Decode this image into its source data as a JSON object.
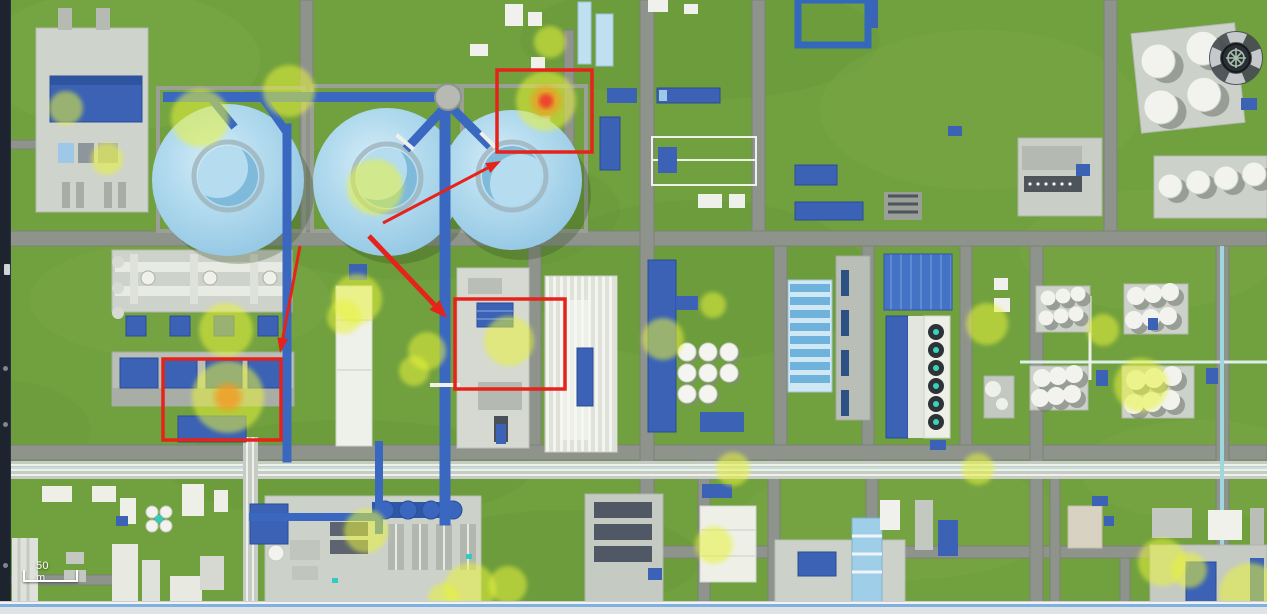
{
  "view": {
    "type": "3d-industrial-site-map"
  },
  "map": {
    "scale_bar": {
      "label": "50 m"
    },
    "compass": {
      "icon": "compass-navigation-icon"
    }
  },
  "colors": {
    "grass": "#71a03e",
    "road": "#8e948c",
    "pad": "#ccd1ca",
    "building_blue": "#3b62b4",
    "sphere_blue": "#a9d7ec",
    "pipe_blue": "#3a68c0",
    "heat_yellow": "#e8f238",
    "heat_core_orange": "#f29a1f",
    "heat_core_red": "#ee3a2e",
    "annotation_red": "#e6231b",
    "sidebar_dark": "#1d2430",
    "bottombar_blue": "#7fb0de"
  },
  "annotations": {
    "boxes": [
      {
        "x": 497,
        "y": 70,
        "w": 95,
        "h": 82
      },
      {
        "x": 163,
        "y": 359,
        "w": 118,
        "h": 81
      },
      {
        "x": 455,
        "y": 299,
        "w": 110,
        "h": 90
      }
    ],
    "arrows": [
      {
        "x1": 383,
        "y1": 223,
        "x2": 501,
        "y2": 161,
        "width": 3
      },
      {
        "x1": 369,
        "y1": 236,
        "x2": 447,
        "y2": 318,
        "width": 5
      },
      {
        "x1": 300,
        "y1": 246,
        "x2": 280,
        "y2": 353,
        "width": 3
      }
    ],
    "heat_markers": [
      {
        "cx": 66,
        "cy": 108,
        "r": 17,
        "core": null
      },
      {
        "cx": 107,
        "cy": 159,
        "r": 16,
        "core": null
      },
      {
        "cx": 200,
        "cy": 118,
        "r": 29,
        "core": null
      },
      {
        "cx": 289,
        "cy": 91,
        "r": 26,
        "core": null
      },
      {
        "cx": 375,
        "cy": 187,
        "r": 28,
        "core": null
      },
      {
        "cx": 550,
        "cy": 42,
        "r": 16,
        "core": null
      },
      {
        "cx": 546,
        "cy": 101,
        "r": 30,
        "core": "red"
      },
      {
        "cx": 226,
        "cy": 330,
        "r": 27,
        "core": null
      },
      {
        "cx": 228,
        "cy": 397,
        "r": 36,
        "core": "orange"
      },
      {
        "cx": 357,
        "cy": 299,
        "r": 25,
        "core": null
      },
      {
        "cx": 344,
        "cy": 317,
        "r": 17,
        "core": null
      },
      {
        "cx": 427,
        "cy": 351,
        "r": 19,
        "core": null
      },
      {
        "cx": 414,
        "cy": 371,
        "r": 15,
        "core": null
      },
      {
        "cx": 509,
        "cy": 341,
        "r": 25,
        "core": null
      },
      {
        "cx": 663,
        "cy": 339,
        "r": 21,
        "core": null
      },
      {
        "cx": 713,
        "cy": 305,
        "r": 13,
        "core": null
      },
      {
        "cx": 987,
        "cy": 324,
        "r": 21,
        "core": null
      },
      {
        "cx": 1103,
        "cy": 330,
        "r": 16,
        "core": null
      },
      {
        "cx": 1141,
        "cy": 385,
        "r": 27,
        "core": null
      },
      {
        "cx": 733,
        "cy": 469,
        "r": 17,
        "core": null
      },
      {
        "cx": 978,
        "cy": 469,
        "r": 16,
        "core": null
      },
      {
        "cx": 366,
        "cy": 531,
        "r": 22,
        "core": null
      },
      {
        "cx": 470,
        "cy": 589,
        "r": 26,
        "core": null
      },
      {
        "cx": 508,
        "cy": 585,
        "r": 19,
        "core": null
      },
      {
        "cx": 444,
        "cy": 599,
        "r": 16,
        "core": null
      },
      {
        "cx": 714,
        "cy": 545,
        "r": 19,
        "core": null
      },
      {
        "cx": 1162,
        "cy": 562,
        "r": 24,
        "core": null
      },
      {
        "cx": 1189,
        "cy": 570,
        "r": 18,
        "core": null
      },
      {
        "cx": 1250,
        "cy": 594,
        "r": 31,
        "core": null
      }
    ]
  }
}
